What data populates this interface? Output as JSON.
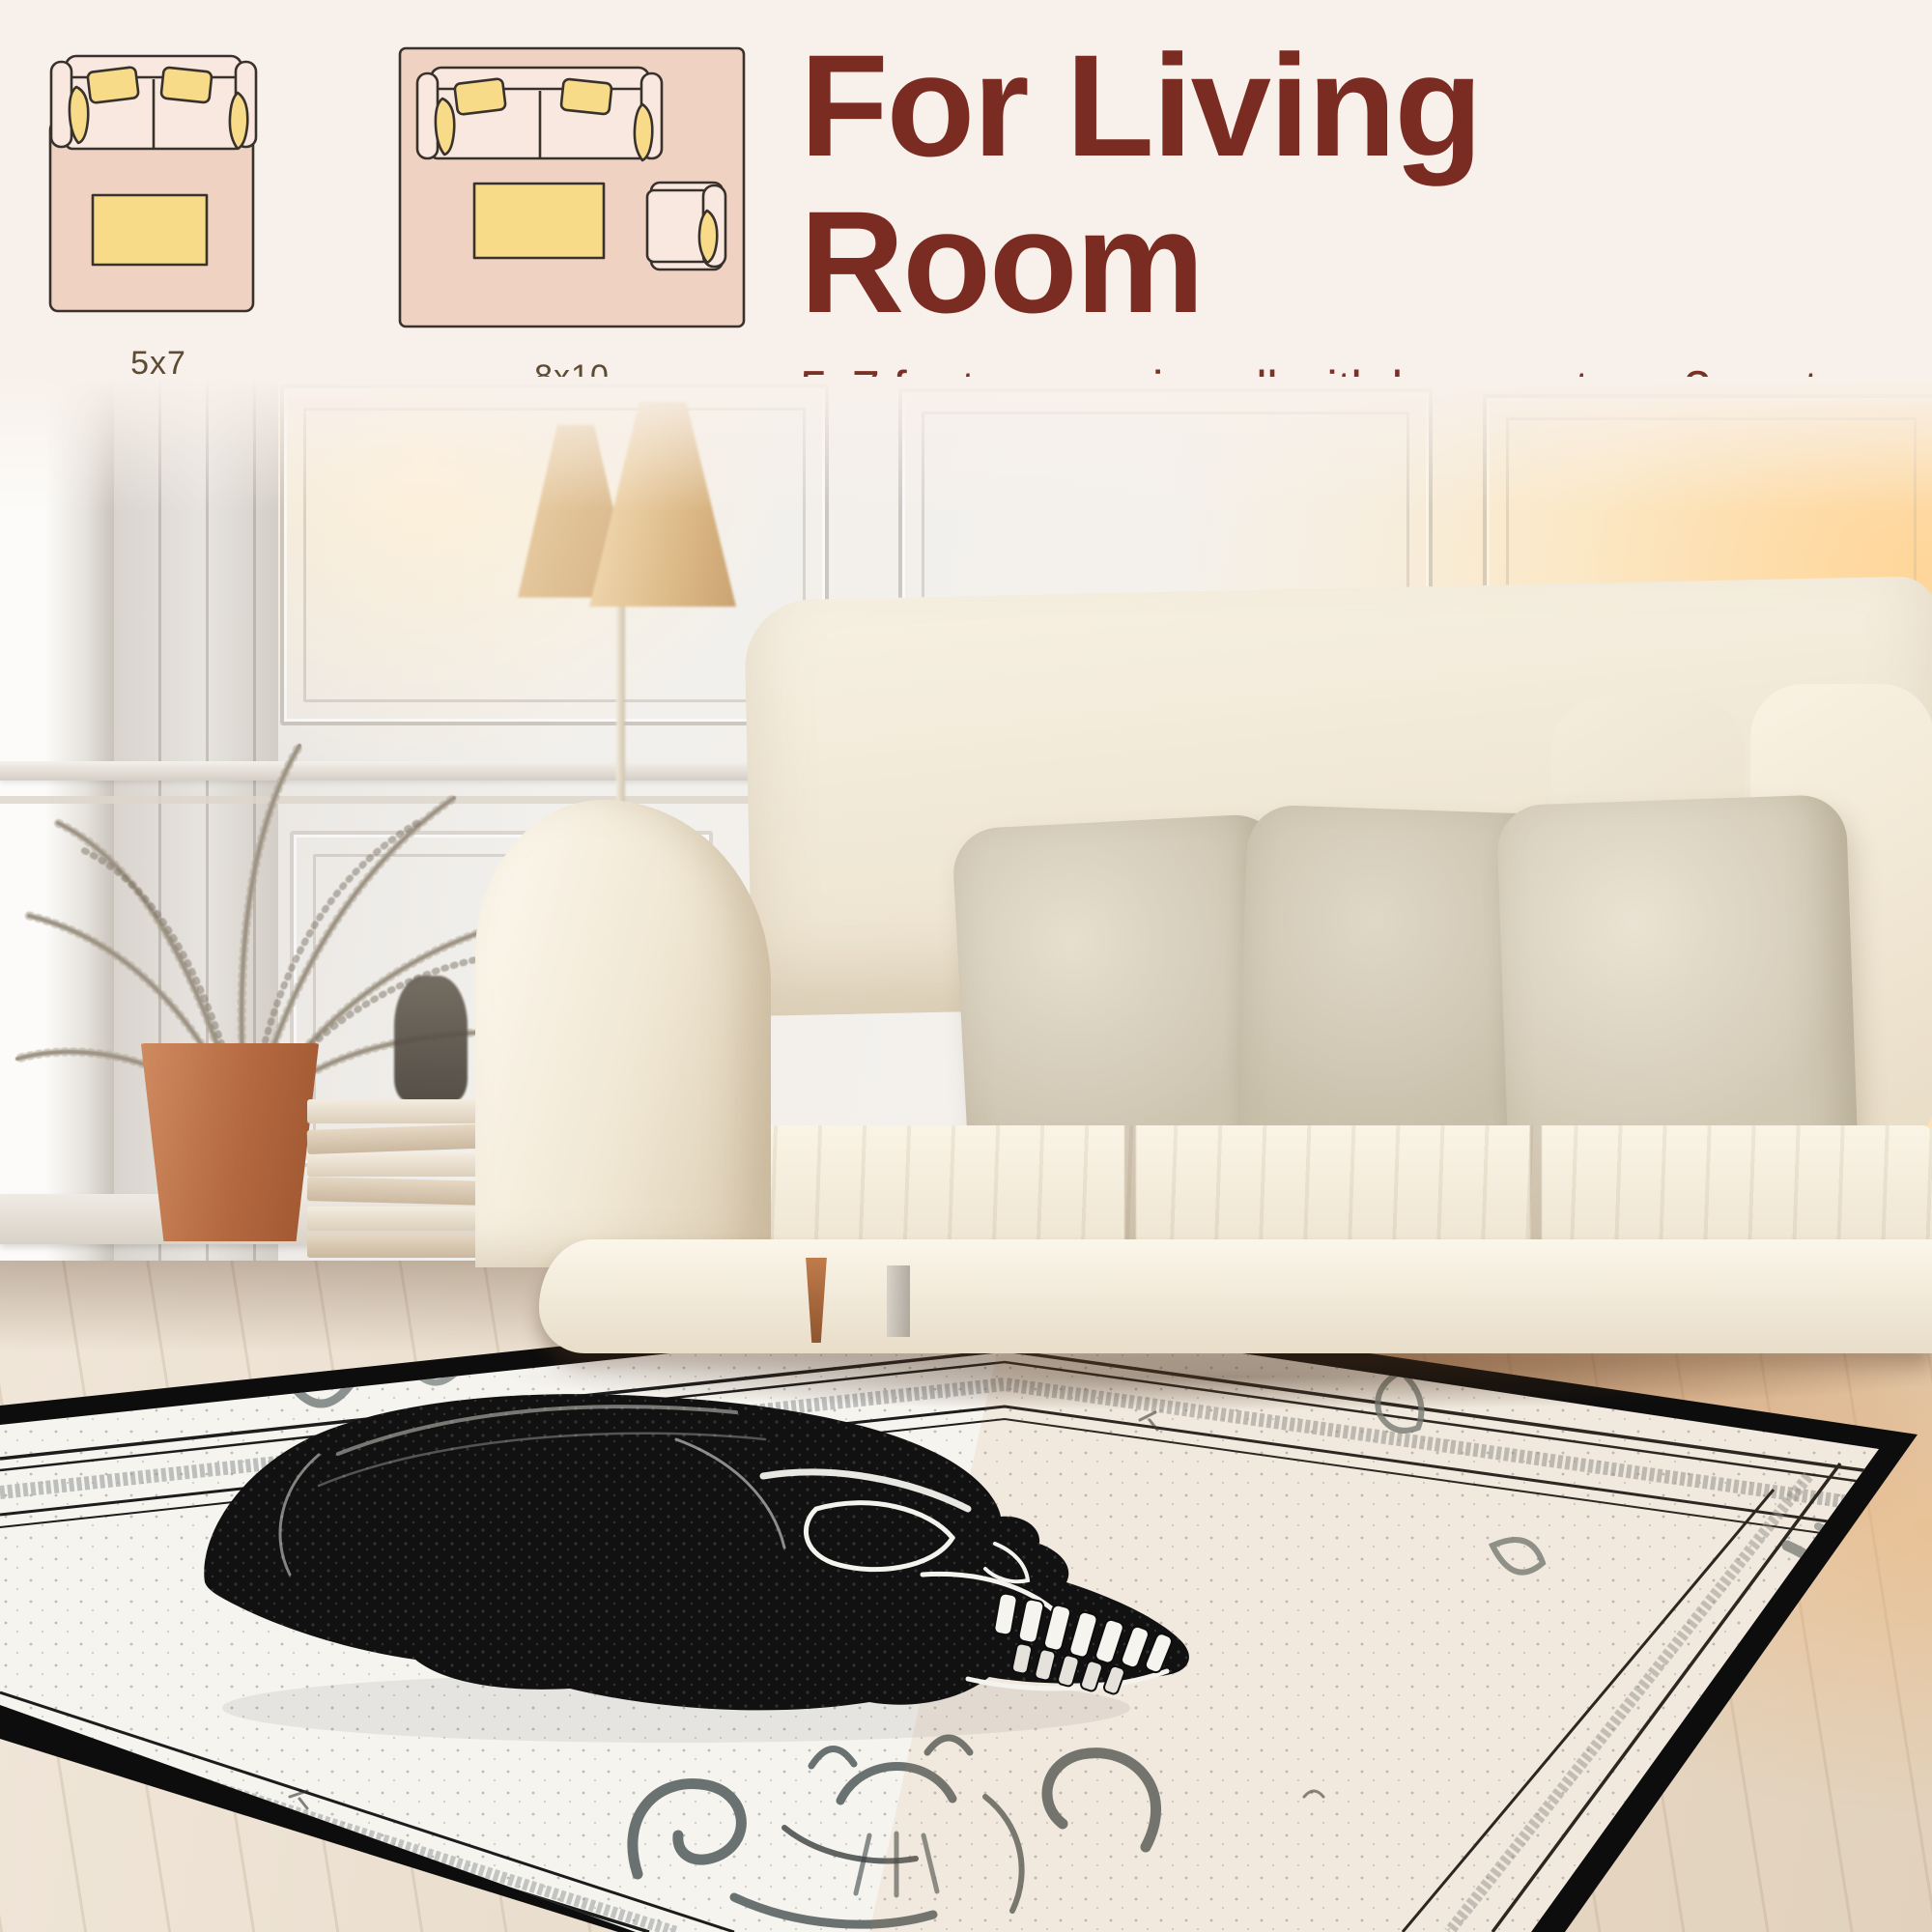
{
  "header": {
    "title": "For Living Room",
    "description_lines": [
      "5x7 foot rugs pair well with love seats or 3 seater",
      "sofas, while 8x10 foot rugs pair well with sectionals."
    ]
  },
  "size_diagrams": [
    {
      "label": "5x7"
    },
    {
      "label": "8x10"
    }
  ],
  "colors": {
    "background": "#f8f1eb",
    "heading_text": "#7b2c22",
    "body_text": "#7c3127",
    "diagram_rug_pink": "#efd2c2",
    "diagram_sofa_cream": "#f8e8df",
    "diagram_accent_yellow": "#f7db88",
    "diagram_outline": "#39322c",
    "diagram_label_text": "#5e4b33",
    "rug_border_black": "#0d0d0d",
    "rug_field_white": "#f6f4ef"
  }
}
